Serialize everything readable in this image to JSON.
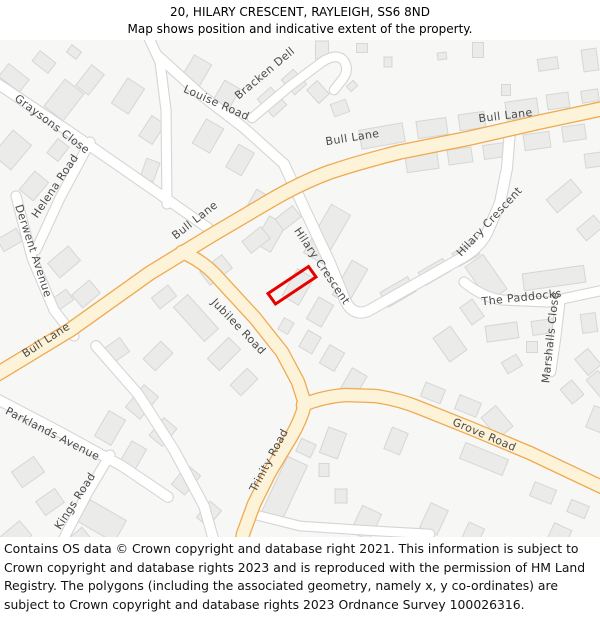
{
  "header": {
    "title": "20, HILARY CRESCENT, RAYLEIGH, SS6 8ND",
    "subtitle": "Map shows position and indicative extent of the property."
  },
  "footer": {
    "text": "Contains OS data © Crown copyright and database right 2021. This information is subject to Crown copyright and database rights 2023 and is reproduced with the permission of HM Land Registry. The polygons (including the associated geometry, namely x, y co-ordinates) are subject to Crown copyright and database rights 2023 Ordnance Survey 100026316."
  },
  "map": {
    "colors": {
      "bg": "#f7f7f5",
      "building_fill": "#ebebe9",
      "building_stroke": "#d6d6d4",
      "white_road_fill": "#ffffff",
      "white_road_casing": "#d5d5d3",
      "yellow_road_fill": "#fdf3d8",
      "yellow_road_casing": "#f0a950",
      "label_color": "#444444",
      "property_outline": "#e60000"
    },
    "roads_white": [
      {
        "name": "graysons-close",
        "d": "M -5,82 L 70,132 L 148,186 L 208,228",
        "w": 9.5
      },
      {
        "name": "helena-road",
        "d": "M 90,142 L 60,198 L 36,250",
        "w": 9
      },
      {
        "name": "derwent-avenue",
        "d": "M 16,196 L 32,258 L 54,310 L 74,336",
        "w": 9
      },
      {
        "name": "north-stub-road",
        "d": "M 148,36 L 160,62 L 166,110 L 167,204",
        "w": 9
      },
      {
        "name": "louise-road",
        "d": "M 158,56 L 200,94 L 244,128 L 284,164",
        "w": 9.5
      },
      {
        "name": "bracken-dell",
        "d": "M 252,118 L 290,86 L 322,62 Q 337,52 344,61 Q 350,70 342,80 L 334,90",
        "w": 8.5
      },
      {
        "name": "hilary-crescent",
        "d": "M 284,164 L 306,212 L 330,263 L 345,300 Q 353,317 368,311 L 430,276 L 458,260 Q 478,250 487,233 L 500,203 L 507,168 L 510,130",
        "w": 10
      },
      {
        "name": "the-paddocks",
        "d": "M 464,282 Q 482,297 502,300 L 548,302 L 604,290",
        "w": 9
      },
      {
        "name": "marshalls-close",
        "d": "M 560,304 L 556,338 L 551,372",
        "w": 8.5
      },
      {
        "name": "parklands-avenue",
        "d": "M -5,398 L 60,432 L 122,466 L 168,497",
        "w": 9.5
      },
      {
        "name": "kings-road",
        "d": "M 110,455 L 88,492 L 66,534 L 58,552",
        "w": 9
      },
      {
        "name": "unnamed-road",
        "d": "M 96,346 L 138,394 L 174,450 L 204,506 L 216,548",
        "w": 9.5
      },
      {
        "name": "bottom-road",
        "d": "M 252,514 L 300,526 L 360,530 L 430,534",
        "w": 8.5
      }
    ],
    "roads_yellow": [
      {
        "name": "bull-lane",
        "d": "M -6,376 L 70,330 L 150,273 L 212,235 L 268,202 Q 300,183 330,172 Q 360,162 400,152 L 470,138 L 540,122 L 606,108",
        "w": 13
      },
      {
        "name": "jubilee-road",
        "d": "M 182,252 Q 205,262 220,280 L 255,318 L 282,352 L 298,382 L 305,404",
        "w": 12
      },
      {
        "name": "trinity-road",
        "d": "M 305,404 Q 301,420 291,437 L 270,472 L 254,504 L 243,534 L 240,552",
        "w": 12
      },
      {
        "name": "grove-road",
        "d": "M 303,405 Q 322,397 345,395 L 375,396 Q 398,399 420,408 L 470,428 L 530,453 L 606,489",
        "w": 12
      }
    ],
    "labels": [
      {
        "id": "graysons-close",
        "text": "Graysons Close",
        "x": 50,
        "y": 127,
        "rot": 37
      },
      {
        "id": "helena-road",
        "text": "Helena Road",
        "x": 58,
        "y": 188,
        "rot": -56
      },
      {
        "id": "derwent-avenue",
        "text": "Derwent Avenue",
        "x": 30,
        "y": 252,
        "rot": 72
      },
      {
        "id": "louise-road",
        "text": "Louise Road",
        "x": 215,
        "y": 106,
        "rot": 24
      },
      {
        "id": "bracken-dell",
        "text": "Bracken Dell",
        "x": 267,
        "y": 76,
        "rot": -40
      },
      {
        "id": "bull-lane-a",
        "text": "Bull Lane",
        "x": 506,
        "y": 119,
        "rot": -7
      },
      {
        "id": "bull-lane-b",
        "text": "Bull Lane",
        "x": 353,
        "y": 141,
        "rot": -9
      },
      {
        "id": "bull-lane-c",
        "text": "Bull Lane",
        "x": 197,
        "y": 223,
        "rot": -38
      },
      {
        "id": "bull-lane-d",
        "text": "Bull Lane",
        "x": 48,
        "y": 343,
        "rot": -33
      },
      {
        "id": "hilary-crescent-mid",
        "text": "Hilary Crescent",
        "x": 319,
        "y": 268,
        "rot": 56
      },
      {
        "id": "hilary-crescent-right",
        "text": "Hilary Crescent",
        "x": 492,
        "y": 224,
        "rot": -47
      },
      {
        "id": "the-paddocks",
        "text": "The Paddocks",
        "x": 522,
        "y": 301,
        "rot": -6
      },
      {
        "id": "marshalls-close",
        "text": "Marshalls Close",
        "x": 554,
        "y": 338,
        "rot": -84
      },
      {
        "id": "jubilee-road",
        "text": "Jubilee Road",
        "x": 236,
        "y": 329,
        "rot": 46
      },
      {
        "id": "trinity-road",
        "text": "Trinity Road",
        "x": 272,
        "y": 462,
        "rot": -62
      },
      {
        "id": "grove-road",
        "text": "Grove Road",
        "x": 483,
        "y": 438,
        "rot": 23
      },
      {
        "id": "parklands-avenue",
        "text": "Parklands Avenue",
        "x": 51,
        "y": 437,
        "rot": 27
      },
      {
        "id": "kings-road",
        "text": "Kings Road",
        "x": 78,
        "y": 503,
        "rot": -57
      }
    ],
    "buildings": [
      [
        14,
        78,
        26,
        16,
        38
      ],
      [
        44,
        62,
        20,
        13,
        38
      ],
      [
        74,
        52,
        12,
        9,
        38
      ],
      [
        64,
        100,
        24,
        34,
        38
      ],
      [
        90,
        80,
        16,
        26,
        38
      ],
      [
        12,
        150,
        24,
        32,
        40
      ],
      [
        34,
        186,
        18,
        24,
        40
      ],
      [
        10,
        240,
        14,
        22,
        60
      ],
      [
        58,
        150,
        14,
        18,
        38
      ],
      [
        128,
        96,
        20,
        30,
        33
      ],
      [
        152,
        130,
        16,
        24,
        33
      ],
      [
        150,
        170,
        14,
        20,
        20
      ],
      [
        196,
        72,
        20,
        28,
        30
      ],
      [
        226,
        96,
        18,
        26,
        30
      ],
      [
        208,
        136,
        20,
        28,
        30
      ],
      [
        240,
        160,
        18,
        26,
        30
      ],
      [
        272,
        102,
        18,
        24,
        -42
      ],
      [
        294,
        82,
        16,
        20,
        -42
      ],
      [
        318,
        92,
        14,
        18,
        -42
      ],
      [
        340,
        108,
        16,
        13,
        -20
      ],
      [
        352,
        86,
        9,
        7,
        -42
      ],
      [
        322,
        50,
        13,
        18,
        0
      ],
      [
        362,
        48,
        11,
        9,
        0
      ],
      [
        388,
        62,
        8,
        10,
        0
      ],
      [
        442,
        56,
        9,
        7,
        -8
      ],
      [
        478,
        50,
        11,
        15,
        0
      ],
      [
        590,
        60,
        15,
        22,
        -8
      ],
      [
        548,
        64,
        20,
        12,
        -8
      ],
      [
        382,
        136,
        44,
        19,
        -10
      ],
      [
        432,
        128,
        30,
        17,
        -8
      ],
      [
        472,
        121,
        26,
        16,
        -8
      ],
      [
        522,
        109,
        32,
        18,
        -8
      ],
      [
        558,
        101,
        22,
        15,
        -8
      ],
      [
        590,
        96,
        17,
        12,
        -8
      ],
      [
        506,
        90,
        9,
        11,
        0
      ],
      [
        422,
        162,
        32,
        17,
        -8
      ],
      [
        460,
        156,
        24,
        15,
        -8
      ],
      [
        494,
        151,
        21,
        14,
        -8
      ],
      [
        537,
        141,
        26,
        16,
        -8
      ],
      [
        574,
        133,
        23,
        15,
        -8
      ],
      [
        594,
        160,
        18,
        14,
        -8
      ],
      [
        564,
        196,
        32,
        17,
        -40
      ],
      [
        590,
        228,
        22,
        15,
        -40
      ],
      [
        327,
        234,
        22,
        56,
        30
      ],
      [
        350,
        282,
        18,
        40,
        30
      ],
      [
        398,
        292,
        32,
        17,
        -30
      ],
      [
        434,
        272,
        28,
        15,
        -30
      ],
      [
        466,
        254,
        24,
        15,
        -30
      ],
      [
        486,
        278,
        22,
        42,
        -35
      ],
      [
        554,
        278,
        62,
        17,
        -8
      ],
      [
        502,
        332,
        32,
        16,
        -8
      ],
      [
        543,
        327,
        22,
        14,
        -8
      ],
      [
        589,
        323,
        15,
        19,
        -8
      ],
      [
        512,
        364,
        17,
        13,
        -30
      ],
      [
        532,
        347,
        11,
        11,
        0
      ],
      [
        588,
        362,
        17,
        21,
        -40
      ],
      [
        572,
        392,
        15,
        19,
        -40
      ],
      [
        472,
        312,
        15,
        21,
        -35
      ],
      [
        450,
        344,
        21,
        29,
        -35
      ],
      [
        497,
        422,
        19,
        27,
        -40
      ],
      [
        258,
        202,
        15,
        21,
        30
      ],
      [
        270,
        234,
        19,
        31,
        30
      ],
      [
        298,
        287,
        19,
        31,
        30
      ],
      [
        320,
        312,
        17,
        25,
        30
      ],
      [
        286,
        326,
        11,
        13,
        30
      ],
      [
        310,
        342,
        15,
        19,
        30
      ],
      [
        332,
        358,
        17,
        21,
        30
      ],
      [
        354,
        382,
        17,
        23,
        30
      ],
      [
        196,
        318,
        46,
        19,
        48
      ],
      [
        224,
        354,
        17,
        30,
        45
      ],
      [
        244,
        382,
        15,
        24,
        45
      ],
      [
        158,
        356,
        17,
        25,
        45
      ],
      [
        142,
        402,
        19,
        29,
        40
      ],
      [
        163,
        432,
        17,
        23,
        40
      ],
      [
        216,
        270,
        28,
        17,
        -38
      ],
      [
        256,
        240,
        24,
        15,
        -38
      ],
      [
        288,
        218,
        22,
        14,
        -38
      ],
      [
        164,
        297,
        21,
        14,
        -38
      ],
      [
        114,
        352,
        26,
        17,
        -35
      ],
      [
        64,
        262,
        19,
        27,
        50
      ],
      [
        86,
        294,
        17,
        23,
        50
      ],
      [
        62,
        300,
        19,
        13,
        -35
      ],
      [
        28,
        472,
        19,
        27,
        55
      ],
      [
        50,
        502,
        17,
        23,
        55
      ],
      [
        110,
        428,
        19,
        29,
        30
      ],
      [
        133,
        456,
        17,
        25,
        30
      ],
      [
        16,
        536,
        19,
        25,
        50
      ],
      [
        80,
        540,
        17,
        19,
        50
      ],
      [
        186,
        480,
        17,
        25,
        40
      ],
      [
        209,
        514,
        15,
        21,
        40
      ],
      [
        284,
        490,
        22,
        64,
        25
      ],
      [
        306,
        448,
        16,
        14,
        25
      ],
      [
        324,
        470,
        10,
        13,
        0
      ],
      [
        341,
        496,
        12,
        14,
        0
      ],
      [
        333,
        443,
        19,
        27,
        20
      ],
      [
        396,
        441,
        17,
        23,
        22
      ],
      [
        433,
        393,
        21,
        15,
        22
      ],
      [
        468,
        406,
        23,
        15,
        22
      ],
      [
        484,
        459,
        46,
        17,
        22
      ],
      [
        543,
        493,
        23,
        15,
        22
      ],
      [
        578,
        509,
        19,
        13,
        22
      ],
      [
        366,
        523,
        21,
        29,
        25
      ],
      [
        434,
        519,
        19,
        27,
        25
      ],
      [
        472,
        536,
        17,
        23,
        25
      ],
      [
        102,
        521,
        42,
        25,
        30
      ],
      [
        597,
        419,
        15,
        23,
        22
      ],
      [
        600,
        385,
        15,
        25,
        -40
      ],
      [
        558,
        538,
        19,
        25,
        25
      ]
    ],
    "property": {
      "polygon_points": "268,293.5 308.5,266.5 316,277 275.5,304"
    }
  }
}
